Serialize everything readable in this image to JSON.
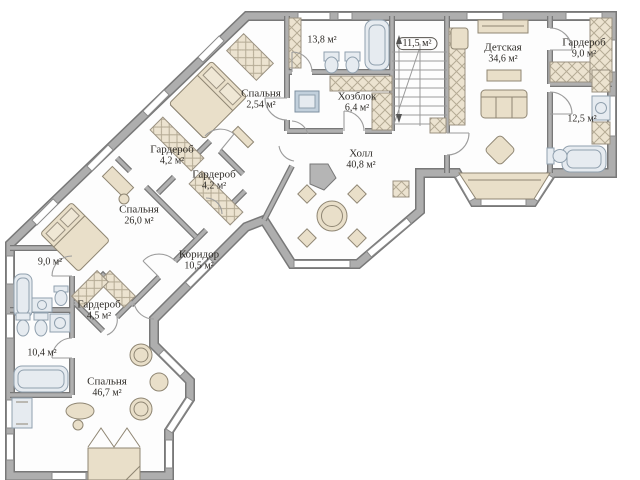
{
  "title": "Floor plan",
  "rooms": {
    "bath_top": {
      "area": "13,8 м²"
    },
    "stairs": {
      "area": "11,5 м²"
    },
    "nursery": {
      "name": "Детская",
      "area": "34,6 м²"
    },
    "wardrobe_ne": {
      "name": "Гардероб",
      "area": "9,0 м²"
    },
    "bath_east": {
      "area": "12,5 м²"
    },
    "utility": {
      "name": "Хозблок",
      "area": "6,4 м²"
    },
    "bedroom_n": {
      "name": "Спальня",
      "area": "2,54 м²"
    },
    "hall": {
      "name": "Холл",
      "area": "40,8 м²"
    },
    "wardrobe_w1": {
      "name": "Гардероб",
      "area": "4,2 м²"
    },
    "wardrobe_w2": {
      "name": "Гардероб",
      "area": "4,2 м²"
    },
    "bedroom_w": {
      "name": "Спальня",
      "area": "26,0 м²"
    },
    "bath_w1": {
      "area": "9,0 м²"
    },
    "wardrobe_sw": {
      "name": "Гардероб",
      "area": "4,5 м²"
    },
    "bath_w2": {
      "area": "10,4 м²"
    },
    "corridor": {
      "name": "Коридор",
      "area": "10,5 м²"
    },
    "bedroom_s": {
      "name": "Спальня",
      "area": "46,7 м²"
    }
  },
  "colors": {
    "wall": "#aeaeae",
    "wall_outline": "#787878",
    "furniture": "#e9dfc9",
    "fixture": "#e6ebf0",
    "text": "#2e2b27"
  }
}
